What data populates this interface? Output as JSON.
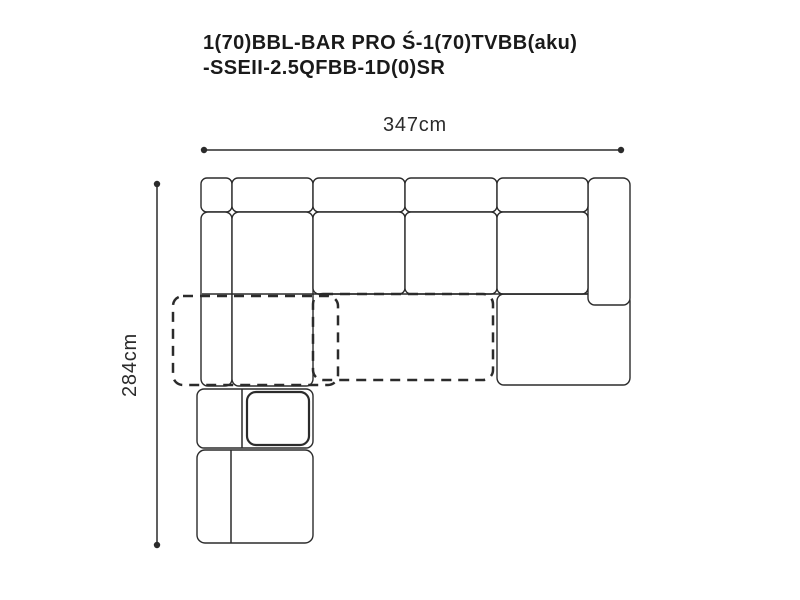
{
  "title": {
    "line1": "1(70)BBL-BAR PRO Ś-1(70)TVBB(aku)",
    "line2": "-SSEII-2.5QFBB-1D(0)SR"
  },
  "dimensions": {
    "width": "347cm",
    "height": "284cm"
  },
  "colors": {
    "background": "#ffffff",
    "line": "#2b2b2b",
    "title_text": "#1a1a1a",
    "dimension_text": "#2b2b2b"
  }
}
